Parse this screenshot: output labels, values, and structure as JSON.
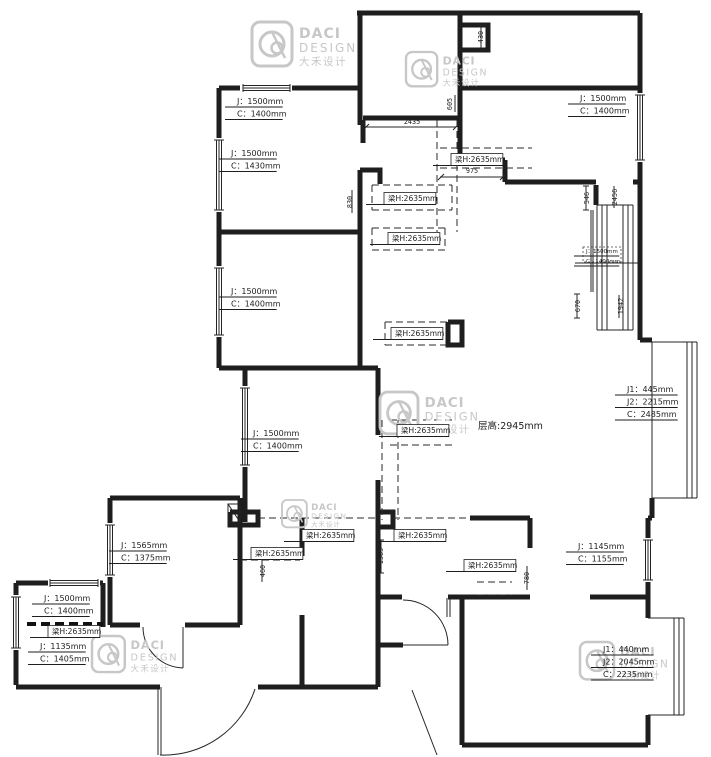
{
  "meta": {
    "title": "apartment floor plan drawing"
  },
  "brand": {
    "name": "DACI",
    "sub": "DESIGN",
    "cn": "大禾设计"
  },
  "colors": {
    "line": "#1e1e1e",
    "watermark": "#c7c7c7",
    "background": "#ffffff"
  },
  "plan": {
    "ceiling_label": "层高:2945mm",
    "beam_text": "梁H:2635mm",
    "window_labels": [
      {
        "x": 237,
        "y": 104,
        "lines": [
          "J：1500mm",
          "C：1400mm"
        ]
      },
      {
        "x": 231,
        "y": 156,
        "lines": [
          "J：1500mm",
          "C：1430mm"
        ]
      },
      {
        "x": 231,
        "y": 294,
        "lines": [
          "J：1500mm",
          "C：1400mm"
        ]
      },
      {
        "x": 253,
        "y": 436,
        "lines": [
          "J：1500mm",
          "C：1400mm"
        ]
      },
      {
        "x": 121,
        "y": 548,
        "lines": [
          "J：1565mm",
          "C：1375mm"
        ]
      },
      {
        "x": 44,
        "y": 601,
        "lines": [
          "J：1500mm",
          "C：1400mm"
        ]
      },
      {
        "x": 40,
        "y": 649,
        "lines": [
          "J：1135mm",
          "C：1405mm"
        ]
      },
      {
        "x": 580,
        "y": 101,
        "lines": [
          "J：1500mm",
          "C：1400mm"
        ]
      },
      {
        "x": 627,
        "y": 392,
        "lines": [
          "J1：445mm",
          "J2：2215mm",
          "C：2485mm"
        ]
      },
      {
        "x": 603,
        "y": 652,
        "lines": [
          "J1：440mm",
          "J2：2045mm",
          "C：2235mm"
        ]
      },
      {
        "x": 578,
        "y": 549,
        "lines": [
          "J：1145mm",
          "C：1155mm"
        ]
      },
      {
        "x": 586,
        "y": 253,
        "lines": [
          "J：1500mm",
          "C：1400mm"
        ],
        "size": 5.5
      }
    ],
    "beam_labels": [
      {
        "x": 455,
        "y": 162
      },
      {
        "x": 388,
        "y": 201
      },
      {
        "x": 392,
        "y": 241
      },
      {
        "x": 395,
        "y": 336
      },
      {
        "x": 401,
        "y": 433
      },
      {
        "x": 306,
        "y": 538
      },
      {
        "x": 255,
        "y": 556
      },
      {
        "x": 398,
        "y": 538
      },
      {
        "x": 468,
        "y": 568
      },
      {
        "x": 52,
        "y": 634
      }
    ],
    "dimensions": [
      {
        "t": "2435",
        "x": 412,
        "y": 124,
        "r": 0
      },
      {
        "t": "975",
        "x": 472,
        "y": 173,
        "r": 0
      },
      {
        "t": "430",
        "x": 483,
        "y": 37,
        "r": -90
      },
      {
        "t": "605",
        "x": 452,
        "y": 104,
        "r": -90
      },
      {
        "t": "830",
        "x": 352,
        "y": 202,
        "r": -90
      },
      {
        "t": "546",
        "x": 589,
        "y": 198,
        "r": -90
      },
      {
        "t": "2456",
        "x": 617,
        "y": 197,
        "r": -90
      },
      {
        "t": "670",
        "x": 580,
        "y": 306,
        "r": -90
      },
      {
        "t": "1942",
        "x": 623,
        "y": 306,
        "r": -90
      },
      {
        "t": "1385",
        "x": 383,
        "y": 556,
        "r": -90
      },
      {
        "t": "460",
        "x": 265,
        "y": 571,
        "r": -90
      },
      {
        "t": "780",
        "x": 529,
        "y": 578,
        "r": -90
      }
    ],
    "watermarks": [
      {
        "x": 252,
        "y": 22,
        "s": 1.0
      },
      {
        "x": 406,
        "y": 52,
        "s": 0.78
      },
      {
        "x": 380,
        "y": 392,
        "s": 0.95
      },
      {
        "x": 282,
        "y": 500,
        "s": 0.62
      },
      {
        "x": 92,
        "y": 636,
        "s": 0.82
      },
      {
        "x": 580,
        "y": 642,
        "s": 0.85
      }
    ]
  }
}
